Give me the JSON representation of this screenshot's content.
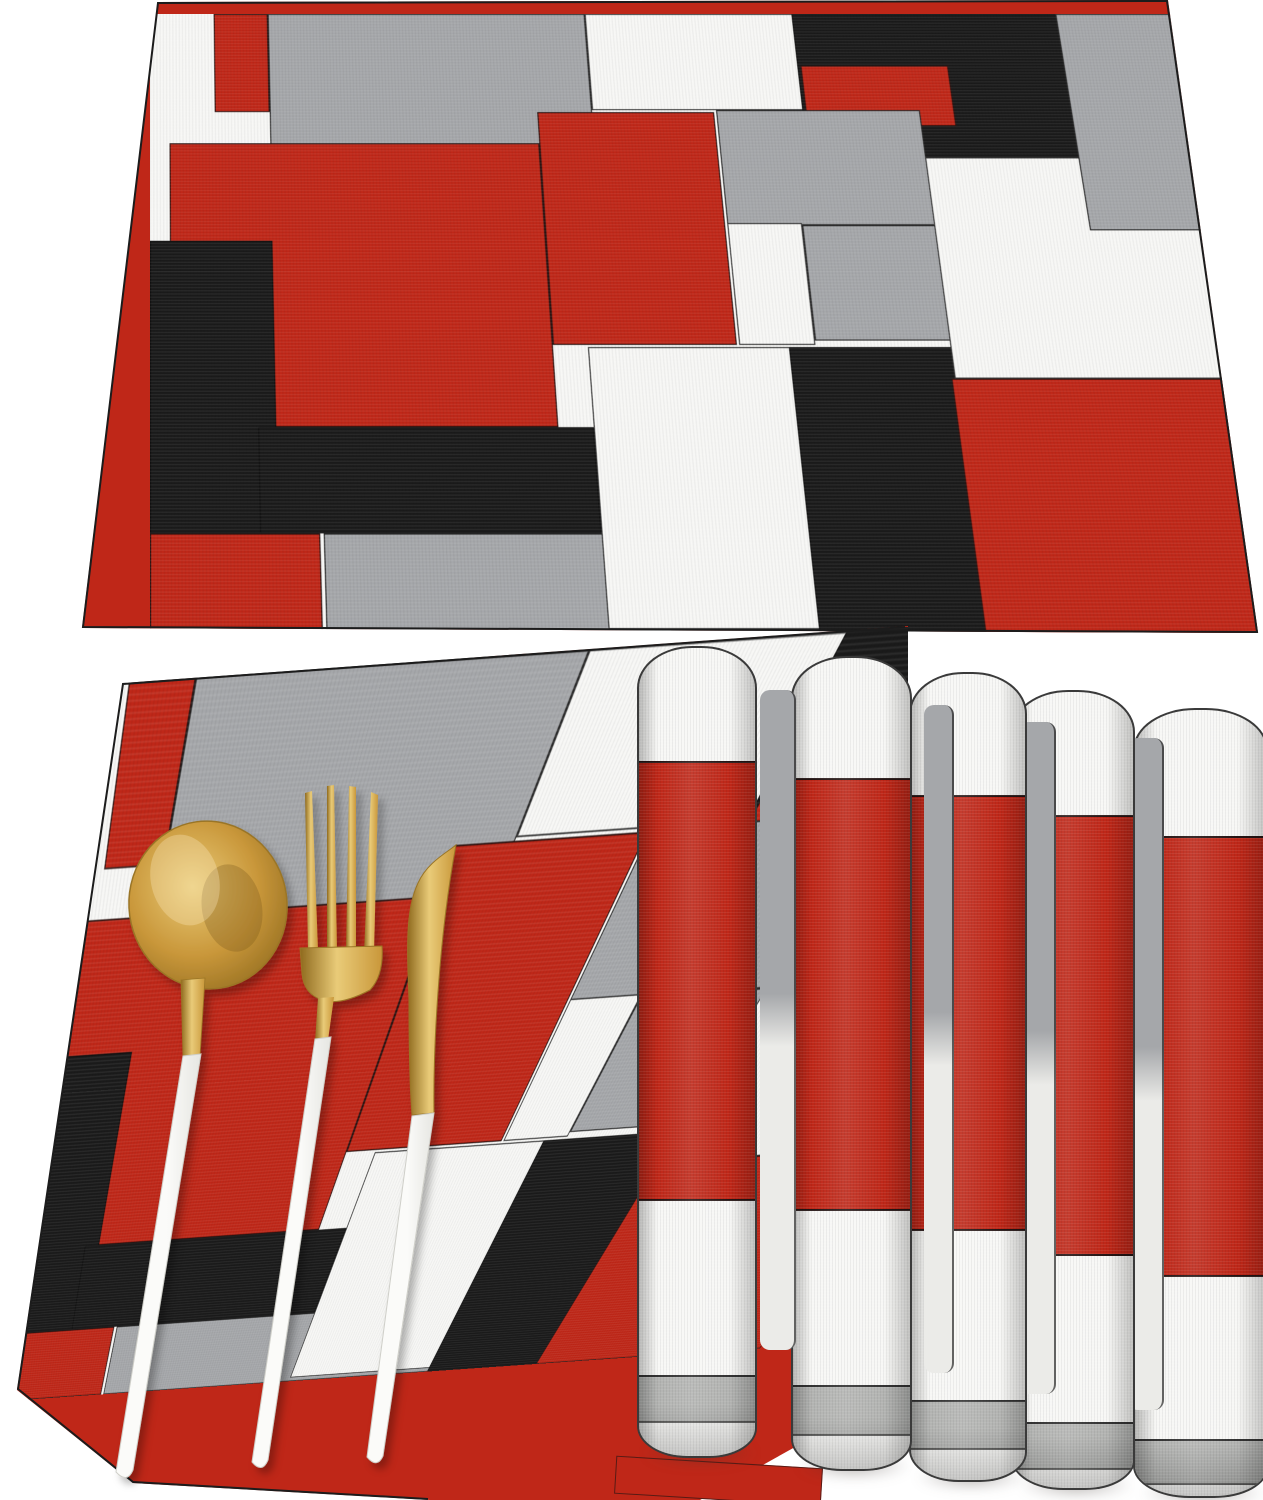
{
  "meta": {
    "description": "Product photo: set of placemats with abstract red, gray, black and white color-block patchwork pattern; one placemat shown flat at top, one flat placemat below with gold spoon, fork and knife with white handles, and four rolled placemats fanned on the right",
    "background_color": "#ffffff"
  },
  "palette": {
    "background": "#ffffff",
    "red": "#bf2718",
    "red_dark": "#a42012",
    "gray": "#a5a7aa",
    "black": "#1a1a1a",
    "white_block": "#f7f7f5",
    "seam": "#141414",
    "curl_gray": "#b3b4b2",
    "gold": "#c9973a",
    "gold_light": "#e9cb78",
    "gold_dark": "#8f6a1e",
    "handle_white": "#fbfbf9",
    "handle_shade": "#e6e6e2"
  },
  "pattern_blocks": [
    {
      "name": "red-top-left",
      "color": "red",
      "x": 60,
      "y": 0,
      "w": 51,
      "h": 100
    },
    {
      "name": "gray-large-top",
      "color": "gray",
      "x": 111,
      "y": 0,
      "w": 299,
      "h": 132
    },
    {
      "name": "white-top-strip",
      "color": "white",
      "x": 410,
      "y": 0,
      "w": 198,
      "h": 98
    },
    {
      "name": "black-top",
      "color": "black",
      "x": 605,
      "y": 0,
      "w": 250,
      "h": 158
    },
    {
      "name": "red-bar",
      "color": "red",
      "x": 608,
      "y": 53,
      "w": 138,
      "h": 61
    },
    {
      "name": "red-center",
      "color": "red",
      "x": 18,
      "y": 131,
      "w": 341,
      "h": 268
    },
    {
      "name": "red-center-arm",
      "color": "red",
      "x": 359,
      "y": 100,
      "w": 164,
      "h": 224
    },
    {
      "name": "gray-mid-a",
      "color": "gray",
      "x": 525,
      "y": 98,
      "w": 189,
      "h": 113
    },
    {
      "name": "white-mid-col",
      "color": "white",
      "x": 525,
      "y": 209,
      "w": 68,
      "h": 115
    },
    {
      "name": "gray-mid-b",
      "color": "gray",
      "x": 593,
      "y": 211,
      "w": 121,
      "h": 109
    },
    {
      "name": "black-left",
      "color": "black",
      "x": 0,
      "y": 226,
      "w": 111,
      "h": 267
    },
    {
      "name": "black-mid-bottom",
      "color": "black",
      "x": 95,
      "y": 399,
      "w": 295,
      "h": 94
    },
    {
      "name": "red-bottom-left",
      "color": "red",
      "x": 0,
      "y": 493,
      "w": 147,
      "h": 87
    },
    {
      "name": "gray-bottom",
      "color": "gray",
      "x": 150,
      "y": 493,
      "w": 443,
      "h": 87
    },
    {
      "name": "white-big-bottom",
      "color": "white",
      "x": 390,
      "y": 326,
      "w": 203,
      "h": 249
    },
    {
      "name": "black-bottom-right",
      "color": "black",
      "x": 569,
      "y": 326,
      "w": 145,
      "h": 254
    },
    {
      "name": "red-bottom-right",
      "color": "red",
      "x": 710,
      "y": 355,
      "w": 290,
      "h": 225
    },
    {
      "name": "white-right-big",
      "color": "white",
      "x": 713,
      "y": 145,
      "w": 287,
      "h": 210
    },
    {
      "name": "gray-top-right-col",
      "color": "gray",
      "x": 854,
      "y": 0,
      "w": 111,
      "h": 216
    }
  ],
  "flat_mats": [
    {
      "name": "placemat-flat-top",
      "position": "top"
    },
    {
      "name": "placemat-flat-left",
      "position": "bottom-left"
    }
  ],
  "rolls": [
    {
      "name": "rolled-placemat-1",
      "x": 637,
      "y": 646,
      "w": 120,
      "h": 812,
      "top_white": 113,
      "red": 436,
      "mid_white": 178,
      "gray": 44,
      "z": 50
    },
    {
      "name": "rolled-placemat-2",
      "x": 791,
      "y": 656,
      "w": 121,
      "h": 815,
      "top_white": 120,
      "red": 429,
      "mid_white": 178,
      "gray": 47,
      "z": 44
    },
    {
      "name": "rolled-placemat-3",
      "x": 909,
      "y": 672,
      "w": 118,
      "h": 810,
      "top_white": 121,
      "red": 432,
      "mid_white": 173,
      "gray": 46,
      "z": 38
    },
    {
      "name": "rolled-placemat-4",
      "x": 1011,
      "y": 690,
      "w": 124,
      "h": 800,
      "top_white": 123,
      "red": 437,
      "mid_white": 170,
      "gray": 44,
      "z": 32
    },
    {
      "name": "rolled-placemat-5",
      "x": 1133,
      "y": 708,
      "w": 135,
      "h": 790,
      "top_white": 126,
      "red": 437,
      "mid_white": 166,
      "gray": 42,
      "z": 26
    }
  ],
  "slivers": [
    {
      "x": 760,
      "y": 690,
      "w": 34,
      "h": 660,
      "z": 47
    },
    {
      "x": 924,
      "y": 705,
      "w": 28,
      "h": 668,
      "z": 41
    },
    {
      "x": 1018,
      "y": 722,
      "w": 36,
      "h": 672,
      "z": 35
    },
    {
      "x": 1128,
      "y": 738,
      "w": 34,
      "h": 672,
      "z": 29
    }
  ],
  "cutlery": {
    "items": [
      "spoon",
      "fork",
      "knife"
    ],
    "metal_color_key": "gold",
    "handle_color_key": "handle_white"
  }
}
